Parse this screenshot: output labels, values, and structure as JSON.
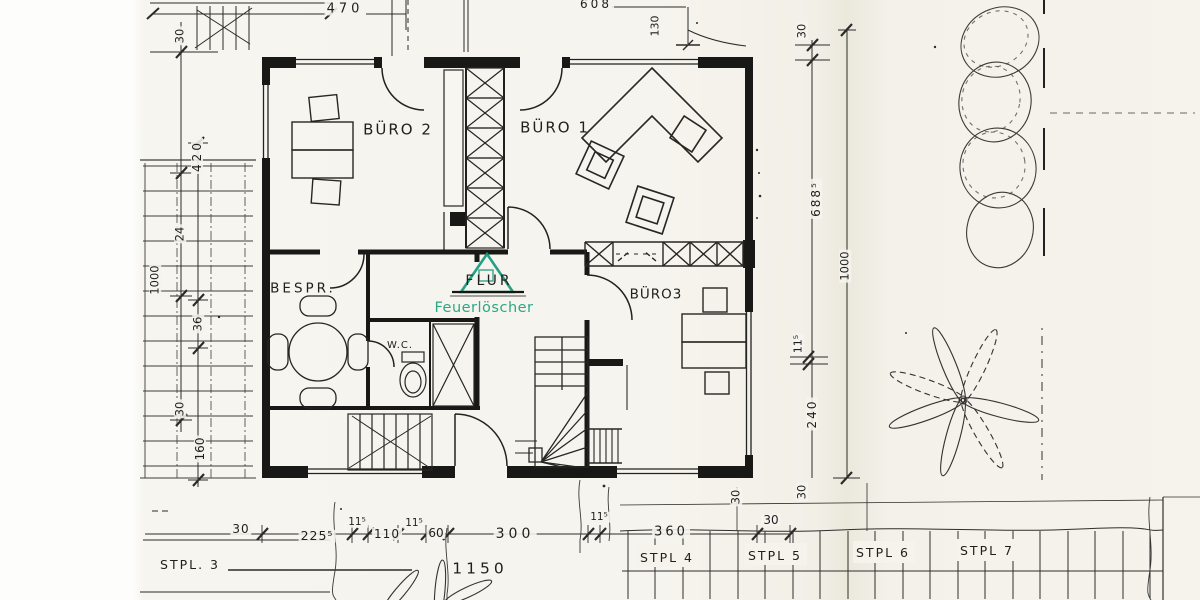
{
  "colors": {
    "ink": "#1f1f1e",
    "green": "#11997b",
    "green_text": "#2aa886"
  },
  "labels": {
    "rooms": [
      {
        "name": "room-label-buero2",
        "text": "BÜRO 2",
        "x": 398,
        "y": 130,
        "size": 15,
        "ls": 2
      },
      {
        "name": "room-label-buero1",
        "text": "BÜRO 1",
        "x": 555,
        "y": 128,
        "size": 15,
        "ls": 2
      },
      {
        "name": "room-label-bespr",
        "text": "BESPR.",
        "x": 303,
        "y": 289,
        "size": 13.5,
        "ls": 3
      },
      {
        "name": "room-label-wc",
        "text": "W.C.",
        "x": 400,
        "y": 346,
        "size": 10,
        "ls": 1
      },
      {
        "name": "room-label-flur",
        "text": "FLUR",
        "x": 489,
        "y": 281,
        "size": 14,
        "ls": 3
      },
      {
        "name": "label-feuerloescher",
        "text": "Feuerlöscher",
        "x": 484,
        "y": 308,
        "size": 14.5,
        "ls": 0.5,
        "color": "green_text"
      },
      {
        "name": "room-label-buero3",
        "text": "BÜRO3",
        "x": 656,
        "y": 295,
        "size": 13.5,
        "ls": 1
      }
    ],
    "dims_top": [
      {
        "name": "dim-470",
        "text": "470",
        "x": 345,
        "y": 9,
        "size": 13,
        "ls": 4,
        "dim": true
      },
      {
        "name": "dim-608",
        "text": "608",
        "x": 596,
        "y": 4,
        "size": 12,
        "ls": 3,
        "dim": true
      },
      {
        "name": "dim-130",
        "text": "130",
        "x": 655,
        "y": 26,
        "size": 11,
        "rot": -90,
        "dim": true
      }
    ],
    "dims_left": [
      {
        "name": "dim-left-30a",
        "text": "30",
        "x": 180,
        "y": 36,
        "size": 11.5,
        "rot": -90,
        "dim": true
      },
      {
        "name": "dim-left-420",
        "text": "420",
        "x": 197,
        "y": 156,
        "size": 12,
        "rot": -90,
        "ls": 3,
        "dim": true
      },
      {
        "name": "dim-left-24",
        "text": "24",
        "x": 180,
        "y": 234,
        "size": 11.5,
        "rot": -90,
        "dim": true
      },
      {
        "name": "dim-left-1000",
        "text": "1000",
        "x": 155,
        "y": 280,
        "size": 11.5,
        "rot": -90,
        "dim": true
      },
      {
        "name": "dim-left-36",
        "text": "36",
        "x": 198,
        "y": 324,
        "size": 11.5,
        "rot": -90,
        "dim": true
      },
      {
        "name": "dim-left-30b",
        "text": "30",
        "x": 180,
        "y": 409,
        "size": 11.5,
        "rot": -90,
        "dim": true
      },
      {
        "name": "dim-left-160",
        "text": "160",
        "x": 200,
        "y": 449,
        "size": 12,
        "rot": -90,
        "dim": true
      }
    ],
    "dims_right": [
      {
        "name": "dim-right-30a",
        "text": "30",
        "x": 802,
        "y": 31,
        "size": 11.5,
        "rot": -90,
        "dim": true
      },
      {
        "name": "dim-right-6885",
        "text": "688⁵",
        "x": 816,
        "y": 199,
        "size": 12,
        "rot": -90,
        "ls": 2,
        "dim": true
      },
      {
        "name": "dim-right-1000",
        "text": "1000",
        "x": 845,
        "y": 266,
        "size": 11.5,
        "rot": -90,
        "dim": true
      },
      {
        "name": "dim-right-115",
        "text": "11⁵",
        "x": 798,
        "y": 344,
        "size": 11,
        "rot": -90,
        "dim": true
      },
      {
        "name": "dim-right-240",
        "text": "240",
        "x": 812,
        "y": 414,
        "size": 12,
        "rot": -90,
        "ls": 2,
        "dim": true
      },
      {
        "name": "dim-right-30b",
        "text": "30",
        "x": 802,
        "y": 492,
        "size": 11.5,
        "rot": -90,
        "dim": true
      },
      {
        "name": "dim-right-30c",
        "text": "30",
        "x": 736,
        "y": 497,
        "size": 11.5,
        "rot": -90,
        "dim": true
      }
    ],
    "dims_bottom": [
      {
        "name": "dim-bot-30a",
        "text": "30",
        "x": 241,
        "y": 529,
        "size": 12,
        "ls": 1,
        "dim": true
      },
      {
        "name": "dim-bot-2255",
        "text": "225⁵",
        "x": 317,
        "y": 536,
        "size": 12.5,
        "ls": 1,
        "dim": true
      },
      {
        "name": "dim-bot-115a",
        "text": "11⁵",
        "x": 357,
        "y": 522,
        "size": 10.5,
        "dim": true
      },
      {
        "name": "dim-bot-110",
        "text": "110",
        "x": 387,
        "y": 534,
        "size": 12,
        "ls": 1,
        "dim": true
      },
      {
        "name": "dim-bot-115b",
        "text": "11⁵",
        "x": 414,
        "y": 523,
        "size": 10.5,
        "dim": true
      },
      {
        "name": "dim-bot-60",
        "text": "60",
        "x": 436,
        "y": 533,
        "size": 12,
        "dim": true
      },
      {
        "name": "dim-bot-300",
        "text": "300",
        "x": 515,
        "y": 534,
        "size": 14,
        "ls": 4,
        "dim": true
      },
      {
        "name": "dim-bot-115c",
        "text": "11⁵",
        "x": 599,
        "y": 517,
        "size": 10.5,
        "dim": true
      },
      {
        "name": "dim-bot-360",
        "text": "360",
        "x": 671,
        "y": 532,
        "size": 13,
        "ls": 3,
        "dim": true
      },
      {
        "name": "dim-bot-30b",
        "text": "30",
        "x": 771,
        "y": 520,
        "size": 12,
        "dim": true
      },
      {
        "name": "dim-bot-1150",
        "text": "1150",
        "x": 480,
        "y": 569,
        "size": 15.5,
        "ls": 4,
        "dim": true
      }
    ],
    "parking": [
      {
        "name": "parking-label-stpl3",
        "text": "STPL. 3",
        "x": 190,
        "y": 565,
        "size": 12.5,
        "ls": 2
      },
      {
        "name": "parking-label-stpl4",
        "text": "STPL 4",
        "x": 667,
        "y": 558,
        "size": 12.5,
        "ls": 2
      },
      {
        "name": "parking-label-stpl5",
        "text": "STPL 5",
        "x": 775,
        "y": 556,
        "size": 12.5,
        "ls": 2
      },
      {
        "name": "parking-label-stpl6",
        "text": "STPL 6",
        "x": 883,
        "y": 553,
        "size": 12.5,
        "ls": 2
      },
      {
        "name": "parking-label-stpl7",
        "text": "STPL 7",
        "x": 987,
        "y": 551,
        "size": 12.5,
        "ls": 2
      }
    ]
  }
}
